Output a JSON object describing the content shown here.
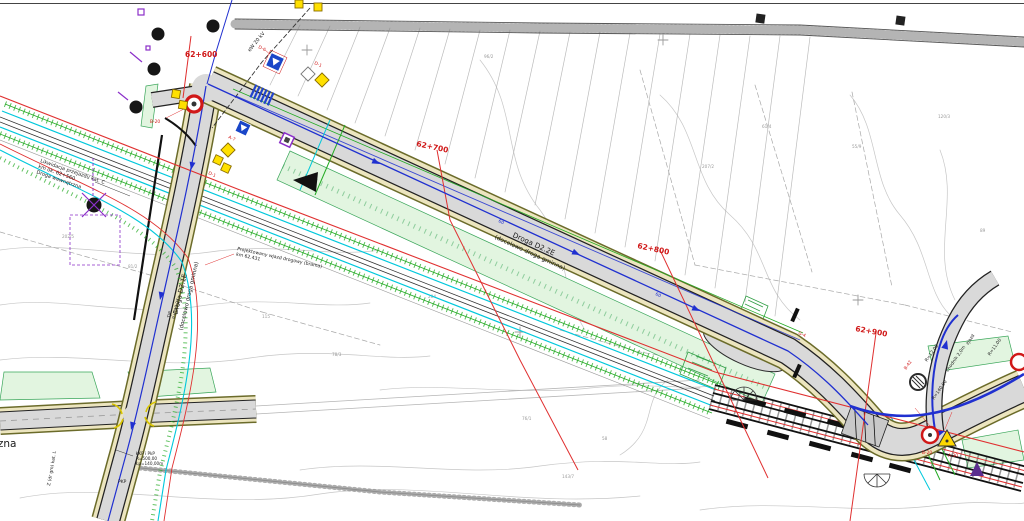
{
  "map": {
    "stations": {
      "s600": "62+600",
      "s700": "62+700",
      "s800": "62+800",
      "s900": "62+900"
    },
    "roads": {
      "d22e_name": "Droga D2.2E",
      "d22e_note": "(docelowo droga gminna)",
      "d21e_name": "Droga D2.1E",
      "d21e_note": "(docelowo droga gminna)",
      "internal_road": "dr. wewnętrzna",
      "internal_kat": "Z (dr gm) kat. L"
    },
    "annotations": {
      "likw1": "Likwidacja przejazdu kat. C",
      "likw2": "km ok. 62+560",
      "likw3": "Droga wewnętrzna",
      "wjazd1": "Projektowany wjazd drogowy (brama)",
      "wjazd2": "km 62.431",
      "power": "eW 20 kV",
      "hm1": "TJP",
      "hm2": "9+113,27",
      "curve1": "ŁKP i PkP",
      "curve2": "R=500,00",
      "curve3": "Łp=140,00m",
      "pkp": "PKP",
      "r1": "R=140,00",
      "r2": "R=12,00",
      "r3": "chodnik 2,0m",
      "r4": "zjazd",
      "r5": "R=11,00",
      "m1": "60",
      "m2": "60"
    },
    "sign_codes": {
      "c1": "B-20",
      "c2": "D-6",
      "c3": "A-7",
      "c4": "D-1",
      "c5": "D-1",
      "c6": "B-42",
      "c7": "B-20",
      "c8": "A-30",
      "c9": "G-4"
    },
    "parcels": [
      "202/5",
      "81/2",
      "115",
      "78/3",
      "204",
      "76/1",
      "58",
      "207/2",
      "61/4",
      "55/9",
      "120/3",
      "89",
      "96/2",
      "143/7"
    ],
    "colors": {
      "road_fill": "#d9d9d9",
      "shoulder": "#ece5bf",
      "axis_blue": "#2030d0",
      "boundary_red": "#e03030",
      "utility_cyan": "#00c8dc",
      "utility_green": "#22aa22",
      "green_area": "#e2f5e0",
      "sign_yellow": "#ffe000",
      "sign_blue": "#1a46c8",
      "sign_purple": "#8b2fc9",
      "station_red": "#d01818"
    }
  }
}
